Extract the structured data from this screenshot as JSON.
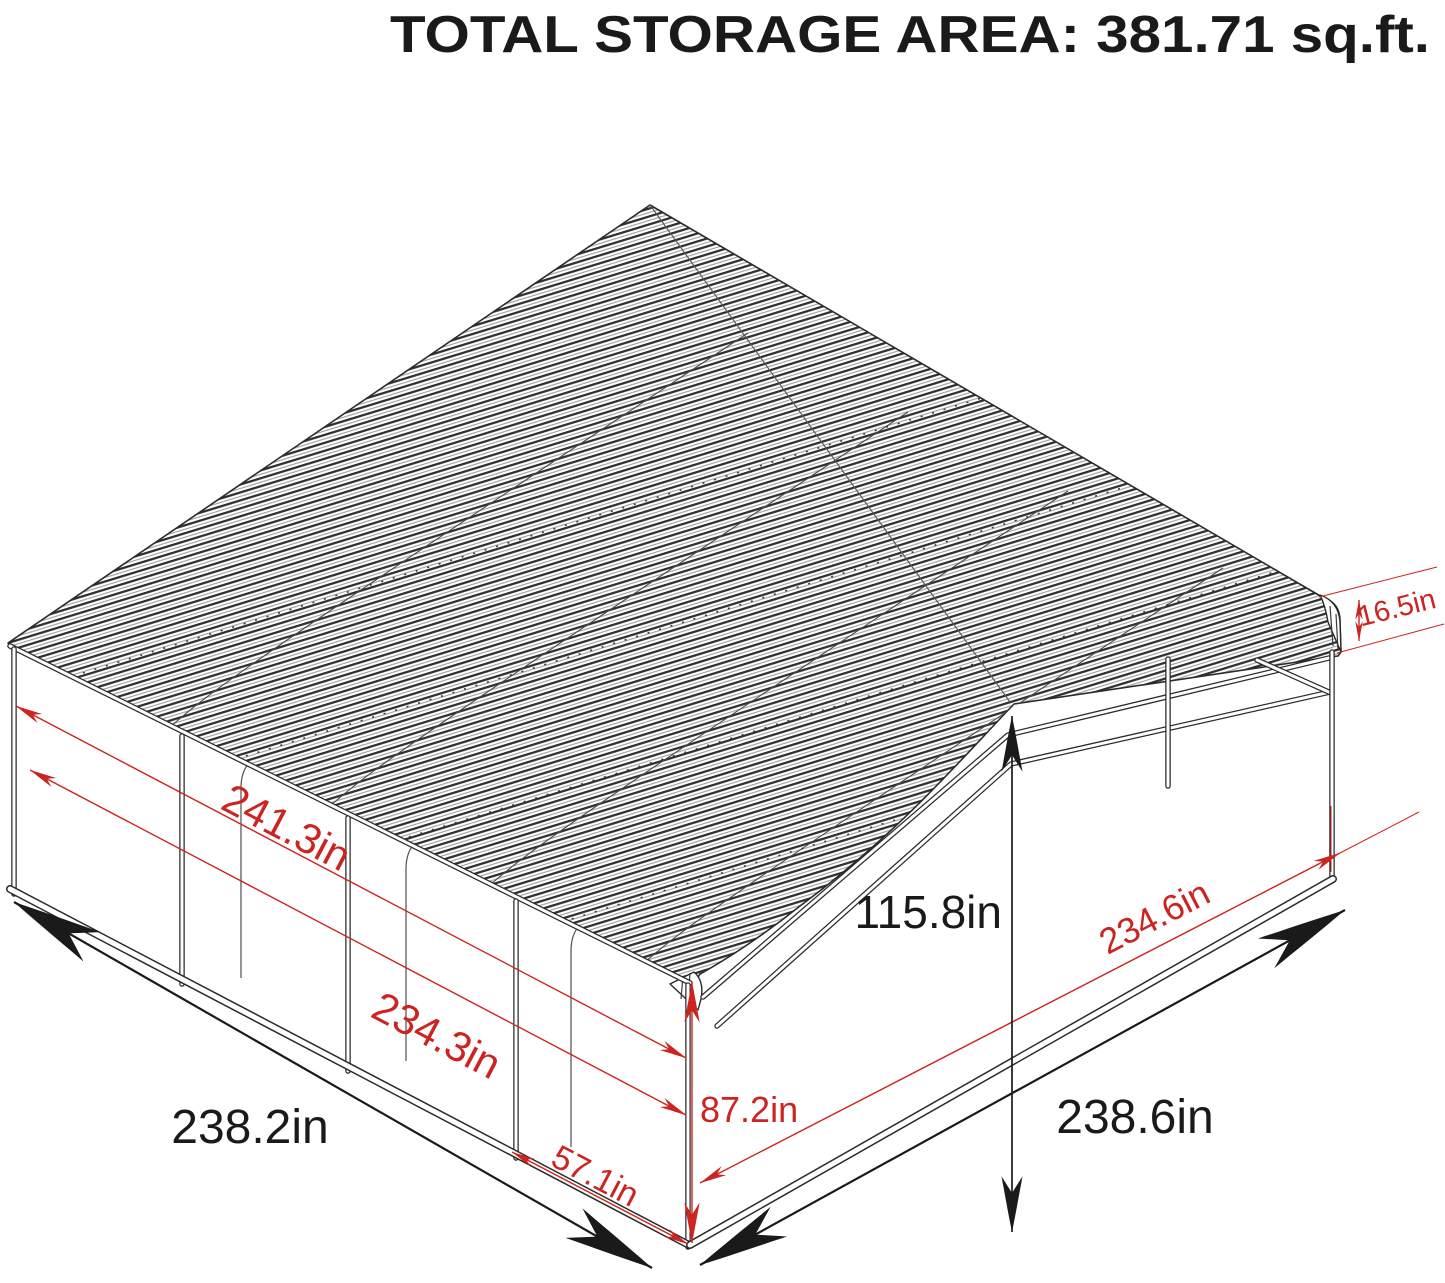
{
  "title": "TOTAL STORAGE AREA: 381.71 sq.ft.",
  "colors": {
    "dimension_red": "#cc2420",
    "line_color": "#2b2b2b",
    "text_black": "#1a1a1a",
    "background": "#ffffff"
  },
  "dimensions": {
    "roof_edge_height": "16.5in",
    "roof_slope_length": "241.3in",
    "side_inner_length": "234.3in",
    "side_base_length": "238.2in",
    "bay_spacing": "57.1in",
    "eave_height": "87.2in",
    "peak_height": "115.8in",
    "front_inner_width": "234.6in",
    "front_base_width": "238.6in"
  }
}
